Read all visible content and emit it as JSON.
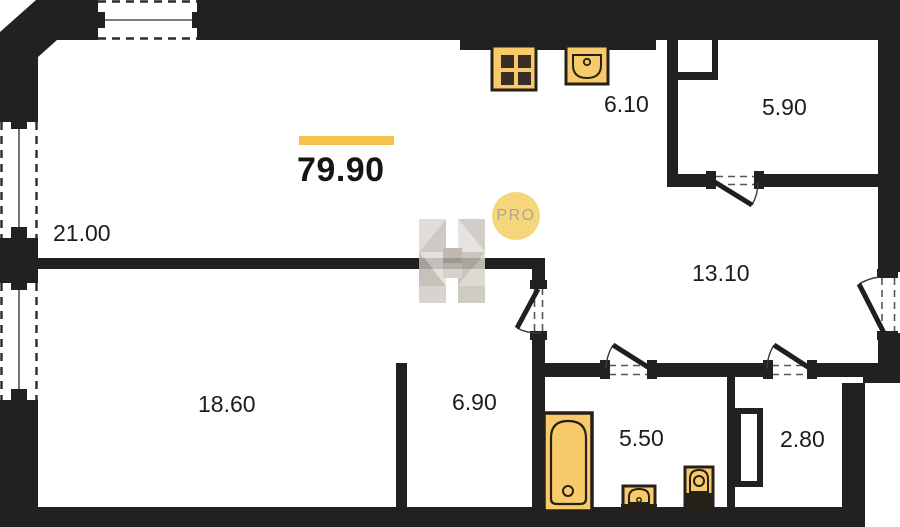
{
  "floor_plan": {
    "total_area": "79.90",
    "room_areas": [
      "21.00",
      "6.10",
      "5.90",
      "13.10",
      "18.60",
      "6.90",
      "5.50",
      "2.80"
    ],
    "watermark_badge": "PRO",
    "colors": {
      "walls": "#212121",
      "accent_bar": "#f5c24b",
      "fixture_fill": "#f9ca6a",
      "fixture_outline": "#26201b",
      "badge_fill": "#f6d67c",
      "badge_text": "#b0a593",
      "watermark_gray": "#cfc9c1",
      "label_text": "#1c1c1c"
    }
  }
}
